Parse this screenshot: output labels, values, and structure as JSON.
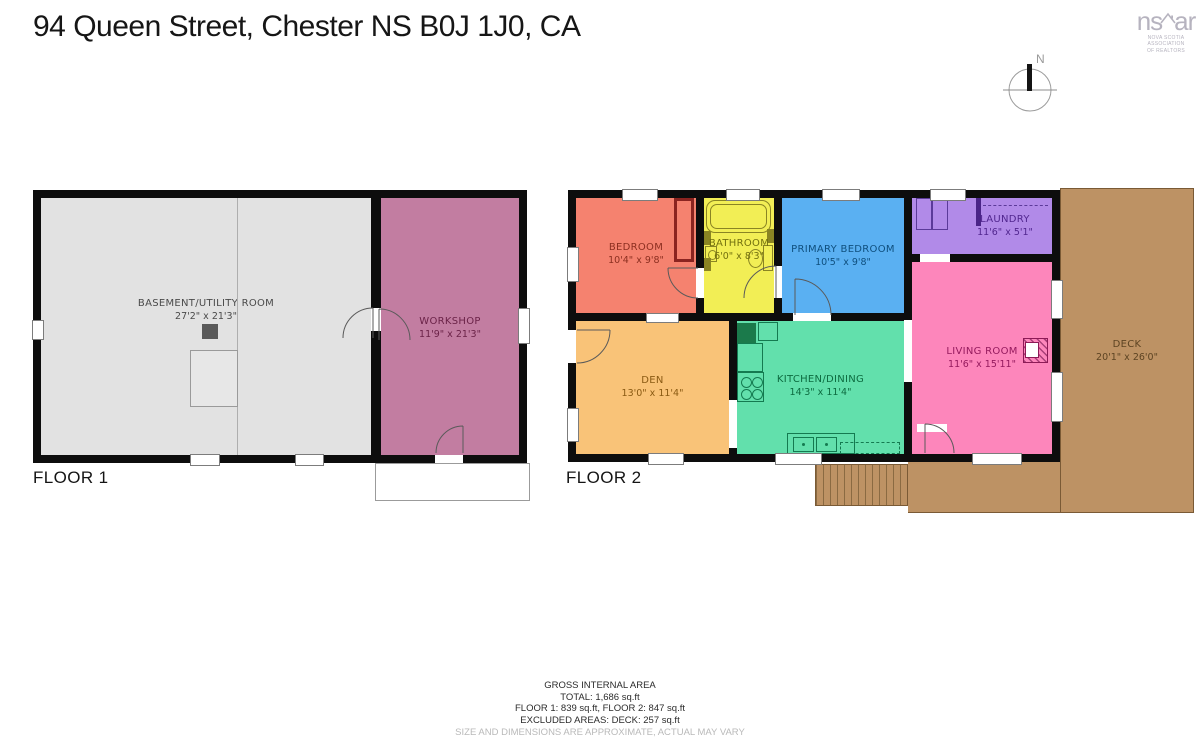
{
  "header": {
    "title": "94 Queen Street, Chester NS B0J 1J0, CA"
  },
  "logo": {
    "part1": "ns",
    "part2": "ar",
    "subtext1": "NOVA SCOTIA ASSOCIATION",
    "subtext2": "OF REALTORS"
  },
  "compass": {
    "north_label": "N"
  },
  "floor1": {
    "label": "FLOOR 1",
    "rooms": [
      {
        "name": "BASEMENT/UTILITY ROOM",
        "dims": "27'2\" x 21'3\"",
        "color": "#e2e2e2"
      },
      {
        "name": "WORKSHOP",
        "dims": "11'9\" x 21'3\"",
        "color": "#c27da1"
      }
    ]
  },
  "floor2": {
    "label": "FLOOR 2",
    "rooms": [
      {
        "name": "BEDROOM",
        "dims": "10'4\" x 9'8\"",
        "color": "#f5826f"
      },
      {
        "name": "BATHROOM",
        "dims": "6'0\" x 8'3\"",
        "color": "#f2ee55"
      },
      {
        "name": "PRIMARY BEDROOM",
        "dims": "10'5\" x 9'8\"",
        "color": "#5ab0f2"
      },
      {
        "name": "LAUNDRY",
        "dims": "11'6\" x 5'1\"",
        "color": "#b18ae8"
      },
      {
        "name": "DEN",
        "dims": "13'0\" x 11'4\"",
        "color": "#f9c378"
      },
      {
        "name": "KITCHEN/DINING",
        "dims": "14'3\" x 11'4\"",
        "color": "#62e0ac"
      },
      {
        "name": "LIVING ROOM",
        "dims": "11'6\" x 15'11\"",
        "color": "#fd86bb"
      },
      {
        "name": "DECK",
        "dims": "20'1\" x 26'0\"",
        "color": "#bd9264"
      }
    ]
  },
  "summary": {
    "line1": "GROSS INTERNAL AREA",
    "line2": "TOTAL: 1,686 sq.ft",
    "line3": "FLOOR 1: 839 sq.ft, FLOOR 2: 847 sq.ft",
    "line4": "EXCLUDED AREAS: DECK: 257 sq.ft",
    "disclaimer": "SIZE AND DIMENSIONS ARE APPROXIMATE, ACTUAL MAY VARY"
  },
  "colors": {
    "walls": "#0d0d0d",
    "deck_border": "#7a5a35",
    "background": "#ffffff"
  }
}
